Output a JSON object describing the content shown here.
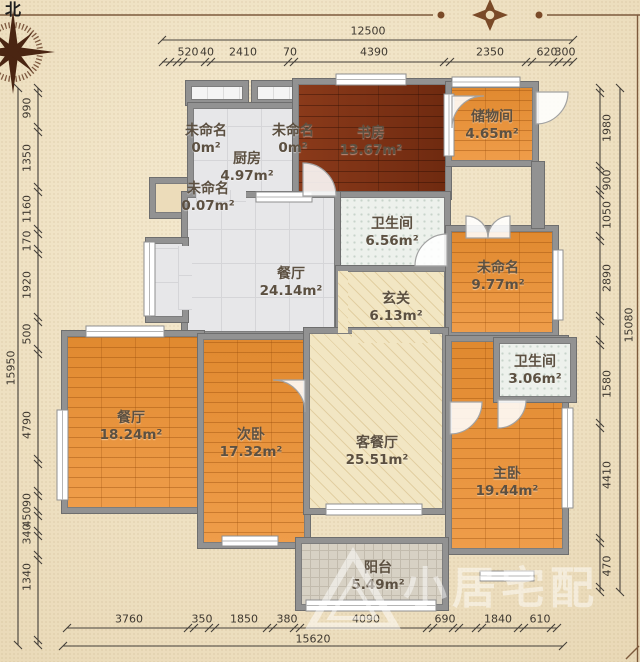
{
  "compass": {
    "north_label": "北"
  },
  "rooms": [
    {
      "name": "未命名",
      "area": "0m²"
    },
    {
      "name": "未命名",
      "area": "0m²"
    },
    {
      "name": "未命名",
      "area": "0.07m²"
    },
    {
      "name": "厨房",
      "area": "4.97m²"
    },
    {
      "name": "书房",
      "area": "13.67m²"
    },
    {
      "name": "储物间",
      "area": "4.65m²"
    },
    {
      "name": "卫生间",
      "area": "6.56m²"
    },
    {
      "name": "餐厅",
      "area": "24.14m²"
    },
    {
      "name": "玄关",
      "area": "6.13m²"
    },
    {
      "name": "未命名",
      "area": "9.77m²"
    },
    {
      "name": "卫生间",
      "area": "3.06m²"
    },
    {
      "name": "餐厅",
      "area": "18.24m²"
    },
    {
      "name": "次卧",
      "area": "17.32m²"
    },
    {
      "name": "客餐厅",
      "area": "25.51m²"
    },
    {
      "name": "主卧",
      "area": "19.44m²"
    },
    {
      "name": "阳台",
      "area": "5.49m²"
    }
  ],
  "dimensions": {
    "top_total": "12500",
    "top_segments": [
      "520",
      "40",
      "2410",
      "70",
      "4390",
      "2350",
      "620",
      "300"
    ],
    "bottom_total": "15620",
    "bottom_segments": [
      "3760",
      "350",
      "1850",
      "380",
      "4090",
      "690",
      "1840",
      "610"
    ],
    "left_total": "15950",
    "left_segments": [
      "990",
      "1350",
      "1160",
      "170",
      "1920",
      "500",
      "4790",
      "90",
      "450",
      "340",
      "1340"
    ],
    "right_total": "15080",
    "right_segments": [
      "1980",
      "900",
      "1050",
      "2890",
      "1580",
      "4410",
      "470"
    ]
  },
  "watermark": {
    "text": "小居宅配"
  },
  "palette": {
    "paper_bg": "#ecdcba",
    "wall_gray": "#929292",
    "wood_dark": "#7c2f12",
    "wood_orange": "#e6913f",
    "tile_gray": "#e7e7e9",
    "tile_bath": "#edf1ec",
    "hatch_beige": "#f2e6c3",
    "balcony_gray": "#d7d1c4",
    "frame_brown": "#7d5a3c",
    "dim_text": "#3e3830"
  }
}
